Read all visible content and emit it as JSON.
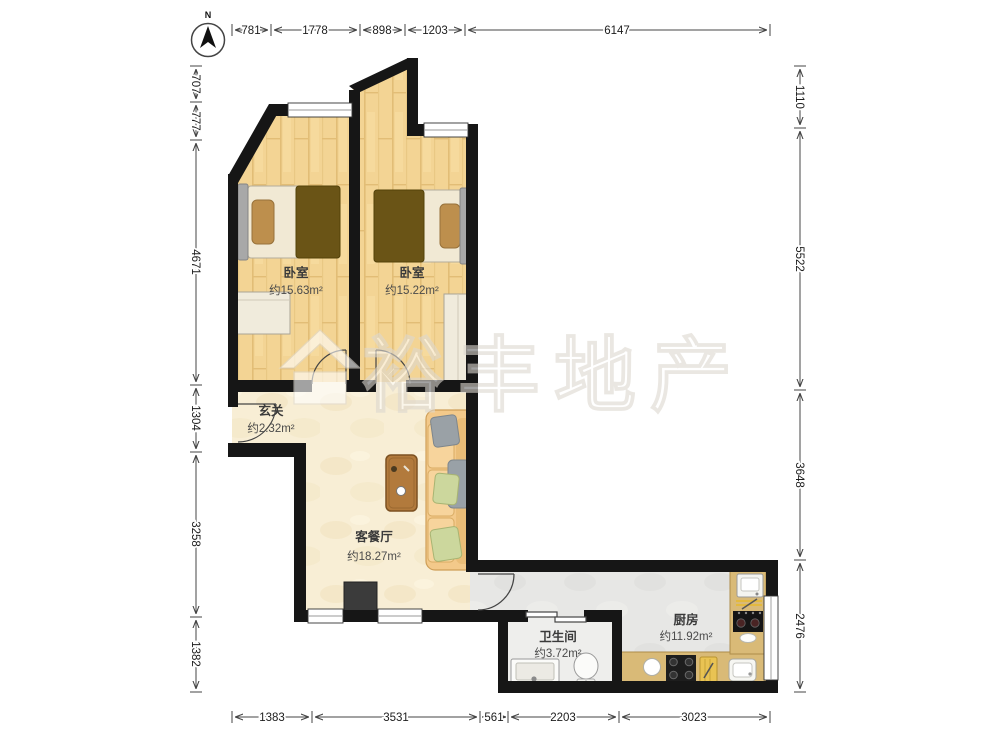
{
  "compass": {
    "label": "N"
  },
  "watermark": {
    "text": "裕丰地产",
    "logo": "house-icon"
  },
  "rooms": {
    "bedroom_left": {
      "name": "卧室",
      "area": "约15.63m²"
    },
    "bedroom_right": {
      "name": "卧室",
      "area": "约15.22m²"
    },
    "entry": {
      "name": "玄关",
      "area": "约2.32m²"
    },
    "living_dining": {
      "name": "客餐厅",
      "area": "约18.27m²"
    },
    "bathroom": {
      "name": "卫生间",
      "area": "约3.72m²"
    },
    "kitchen": {
      "name": "厨房",
      "area": "约11.92m²"
    }
  },
  "dimensions_mm": {
    "top": [
      "781",
      "1778",
      "898",
      "1203",
      "6147"
    ],
    "bottom": [
      "1383",
      "3531",
      "561",
      "2203",
      "3023"
    ],
    "left": [
      "707",
      "777",
      "4671",
      "1304",
      "3258",
      "1382"
    ],
    "right": [
      "1110",
      "5522",
      "3648",
      "2476"
    ]
  },
  "colors": {
    "wall": "#161616",
    "wood_floor": "#f3d494",
    "living_floor": "#f8eed5",
    "tile_floor": "#e7e7e5",
    "bath_floor": "#eeeeec",
    "counter": "#d9ba77",
    "duvet": "#6a5416",
    "sofa": "#f3c98a"
  }
}
